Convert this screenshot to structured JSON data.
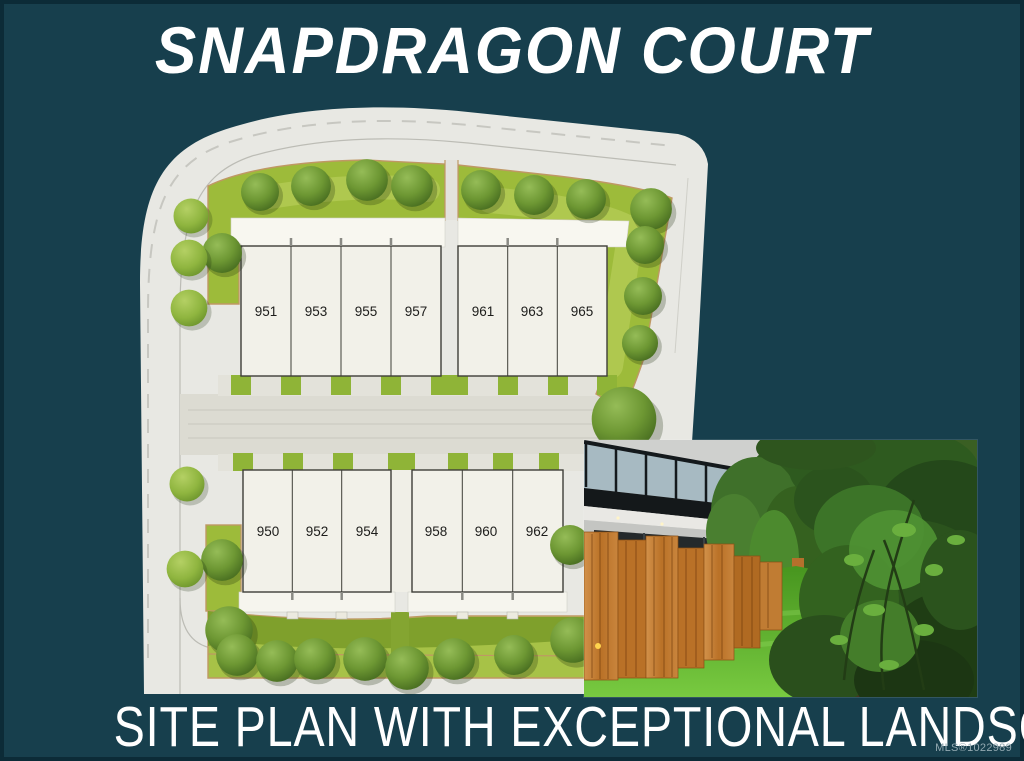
{
  "header": {
    "title": "SNAPDRAGON COURT"
  },
  "footer": {
    "caption": "SITE PLAN WITH EXCEPTIONAL LANDSCAPE",
    "mls_label": "MLS®1022989"
  },
  "site_plan": {
    "buildings": [
      {
        "name": "north-west-building",
        "units": [
          "951",
          "953",
          "955",
          "957"
        ]
      },
      {
        "name": "north-east-building",
        "units": [
          "961",
          "963",
          "965"
        ]
      },
      {
        "name": "south-west-building",
        "units": [
          "950",
          "952",
          "954"
        ]
      },
      {
        "name": "south-east-building",
        "units": [
          "958",
          "960",
          "962"
        ]
      }
    ]
  },
  "colors": {
    "background_teal": "#173f4d",
    "pavement_gray": "#e8e8e3",
    "lawn_green": "#9dbb3a",
    "landscape_border_tan": "#bf9864",
    "building_white": "#f2f1e9",
    "photo_lawn_green": "#58a82c",
    "cedar_fence_orange": "#c9853d",
    "title_text": "#ffffff"
  }
}
